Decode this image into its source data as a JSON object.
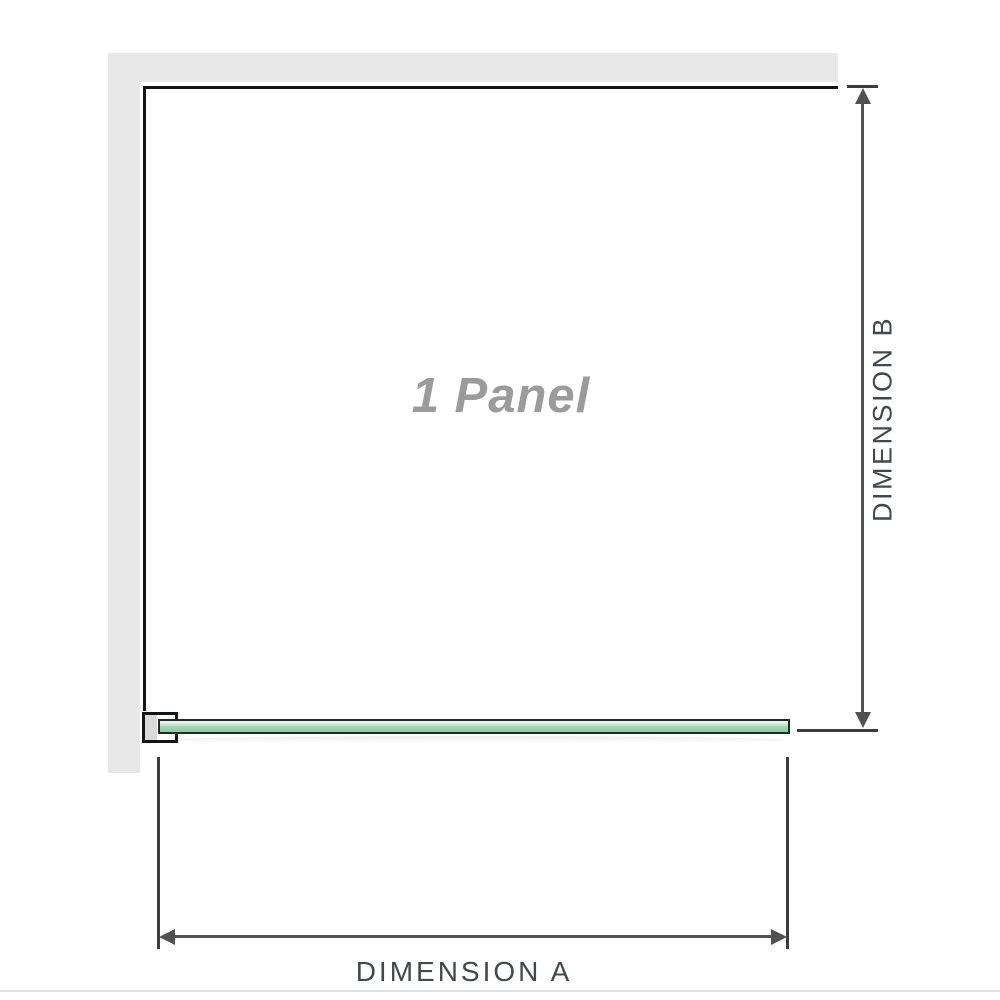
{
  "diagram": {
    "watermark_label": "1 Panel",
    "dimension_a": {
      "label": "DIMENSION A"
    },
    "dimension_b": {
      "label": "DIMENSION B"
    }
  },
  "colors": {
    "wall": "#e8e8e8",
    "outline": "#141414",
    "bracket_fill": "#d9d9d9",
    "glass_border": "#222b24",
    "glass_top": "#f2faf4",
    "glass_mid": "#9ad4ab",
    "glass_deep": "#8ccd9f",
    "dim": "#515151",
    "tick": "#3c3c3c",
    "label": "#45484b",
    "watermark": "#9b9b9b",
    "divider": "#e1e1e1"
  }
}
